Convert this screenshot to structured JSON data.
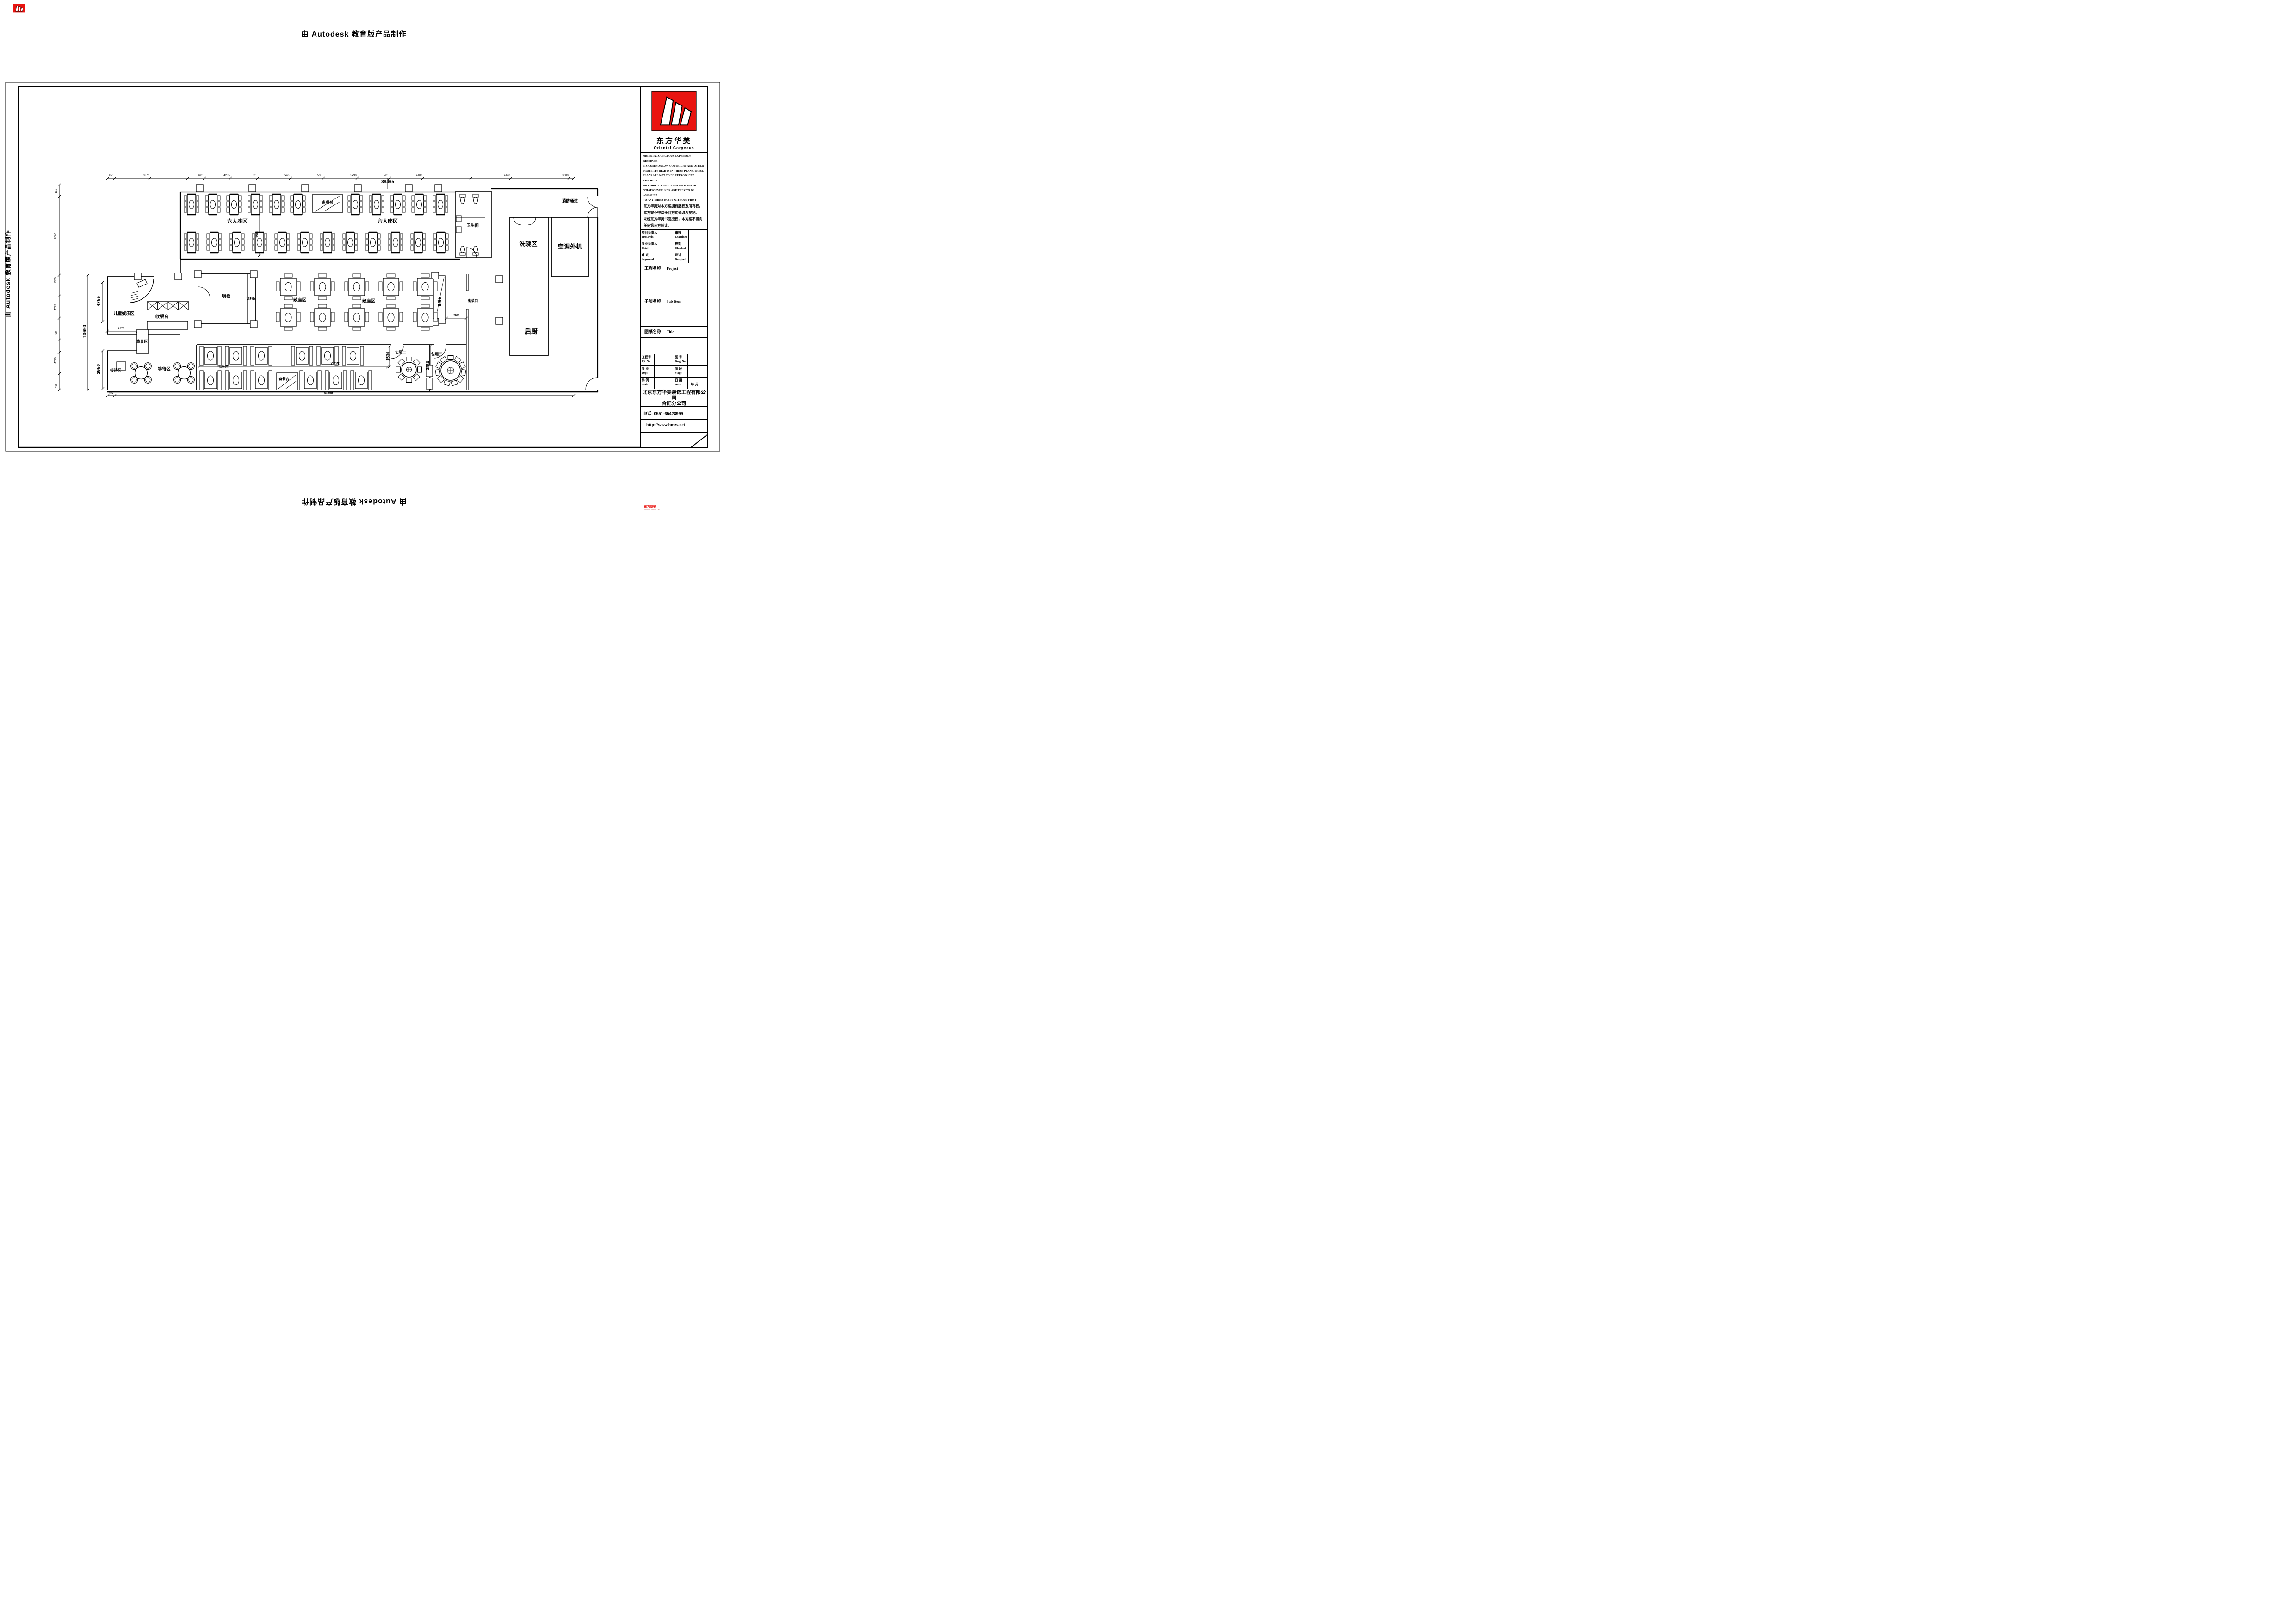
{
  "stamp": {
    "text": "由 Autodesk 教育版产品制作"
  },
  "corner": {
    "brand": "东方华美",
    "site": "www.hmzs.net"
  },
  "plan": {
    "zones": {
      "liurenzuo": "六人座区",
      "beicantai": "备餐台",
      "weishengjian": "卫生间",
      "xiaofang": "消防通道",
      "xiwan": "洗碗区",
      "kongtiao": "空调外机",
      "houchu": "后厨",
      "chucaikou": "出菜口",
      "mingdang": "明档",
      "tiaoliao": "调料区",
      "sanzuo": "散座区",
      "ertong": "儿童娱乐区",
      "shouyin": "收银台",
      "zaojing": "造景区",
      "jiedai": "接待区",
      "dengdai": "等待区",
      "kazuo": "卡座区",
      "baoxiang2": "包厢二",
      "baoxiang3": "包厢三"
    },
    "dims": {
      "total_top": "38465",
      "total_bottom": "41865",
      "left_total": "10690",
      "left_upper": "4755",
      "left_lower": "2950",
      "aisle": "7720",
      "booth": "1530",
      "room3": "3820",
      "passout": "2641",
      "child": "2375",
      "row_gap": "1500",
      "left_edge": "450",
      "top_ticks": [
        "450",
        "3375",
        "620",
        "4235",
        "520",
        "5495",
        "535",
        "5490",
        "520",
        "4100",
        "4190",
        "3000"
      ],
      "left_ticks": [
        "150",
        "8000",
        "1350",
        "4775",
        "460",
        "4770",
        "400"
      ]
    }
  },
  "titleblock": {
    "logo": {
      "cn": "东方华美",
      "en": "Oriental  Gorgeous"
    },
    "copyright_en": "ORIENTAL GORGEOUS EXPRESSLY RESERVES\nITS COMMON LAW COPYRIGHT AND OTHER\nPROPERTY RIGHTS IN THESE PLANS. THESE\nPLANS ARE NOT TO BE REPRODUCED CHANGED\nOR COPIED IN ANY FORM OR MANNER\nWHATSOEVER. NOR ARE THEY TO BE ASSIGHED\nTO ANY THIRD PARTY WITHOUT FIRST\nOBTAINING THE EXPRESSED WRITTEN\nPERMISSION AND CONSENT OF ORIENTAL\nGORGEOUS",
    "disclaimer_cn": "东方华美对本方案拥有版权及所有权。\n本方案不得以任何方式修改及复制。\n未经东方华美书面授权，本方案不得向\n任何第三方转让。",
    "grid1": [
      {
        "cn": "项目负责人",
        "en": "Item.Prin"
      },
      {
        "cn": "审核",
        "en": "Examined"
      },
      {
        "cn": "专业负责人",
        "en": "Chief"
      },
      {
        "cn": "校对",
        "en": "Checked"
      },
      {
        "cn": "审 定",
        "en": "Approved"
      },
      {
        "cn": "设计",
        "en": "Designed"
      }
    ],
    "project": {
      "cn": "工程名称",
      "en": "Project"
    },
    "subitem": {
      "cn": "子项名称",
      "en": "Sub Item"
    },
    "sheet": {
      "cn": "图纸名称",
      "en": "Title"
    },
    "grid2": [
      {
        "cn": "工程号",
        "en": "Pjt .No."
      },
      {
        "cn": "图 号",
        "en": "Dwg. No."
      },
      {
        "cn": "专 业",
        "en": "Dept."
      },
      {
        "cn": "阶 段",
        "en": "Stage"
      },
      {
        "cn": "比 例",
        "en": "Scale"
      },
      {
        "cn": "日 期",
        "en": "Date"
      }
    ],
    "date_value": "年    月",
    "company": "北京东方华美装饰工程有限公司",
    "branch": "合肥分公司",
    "address": "安徽省合肥市马鞍山南路绿地赢海大厦B座19楼",
    "phone": "电话: 0551-65428999",
    "web": "http://www.hmzs.net"
  }
}
